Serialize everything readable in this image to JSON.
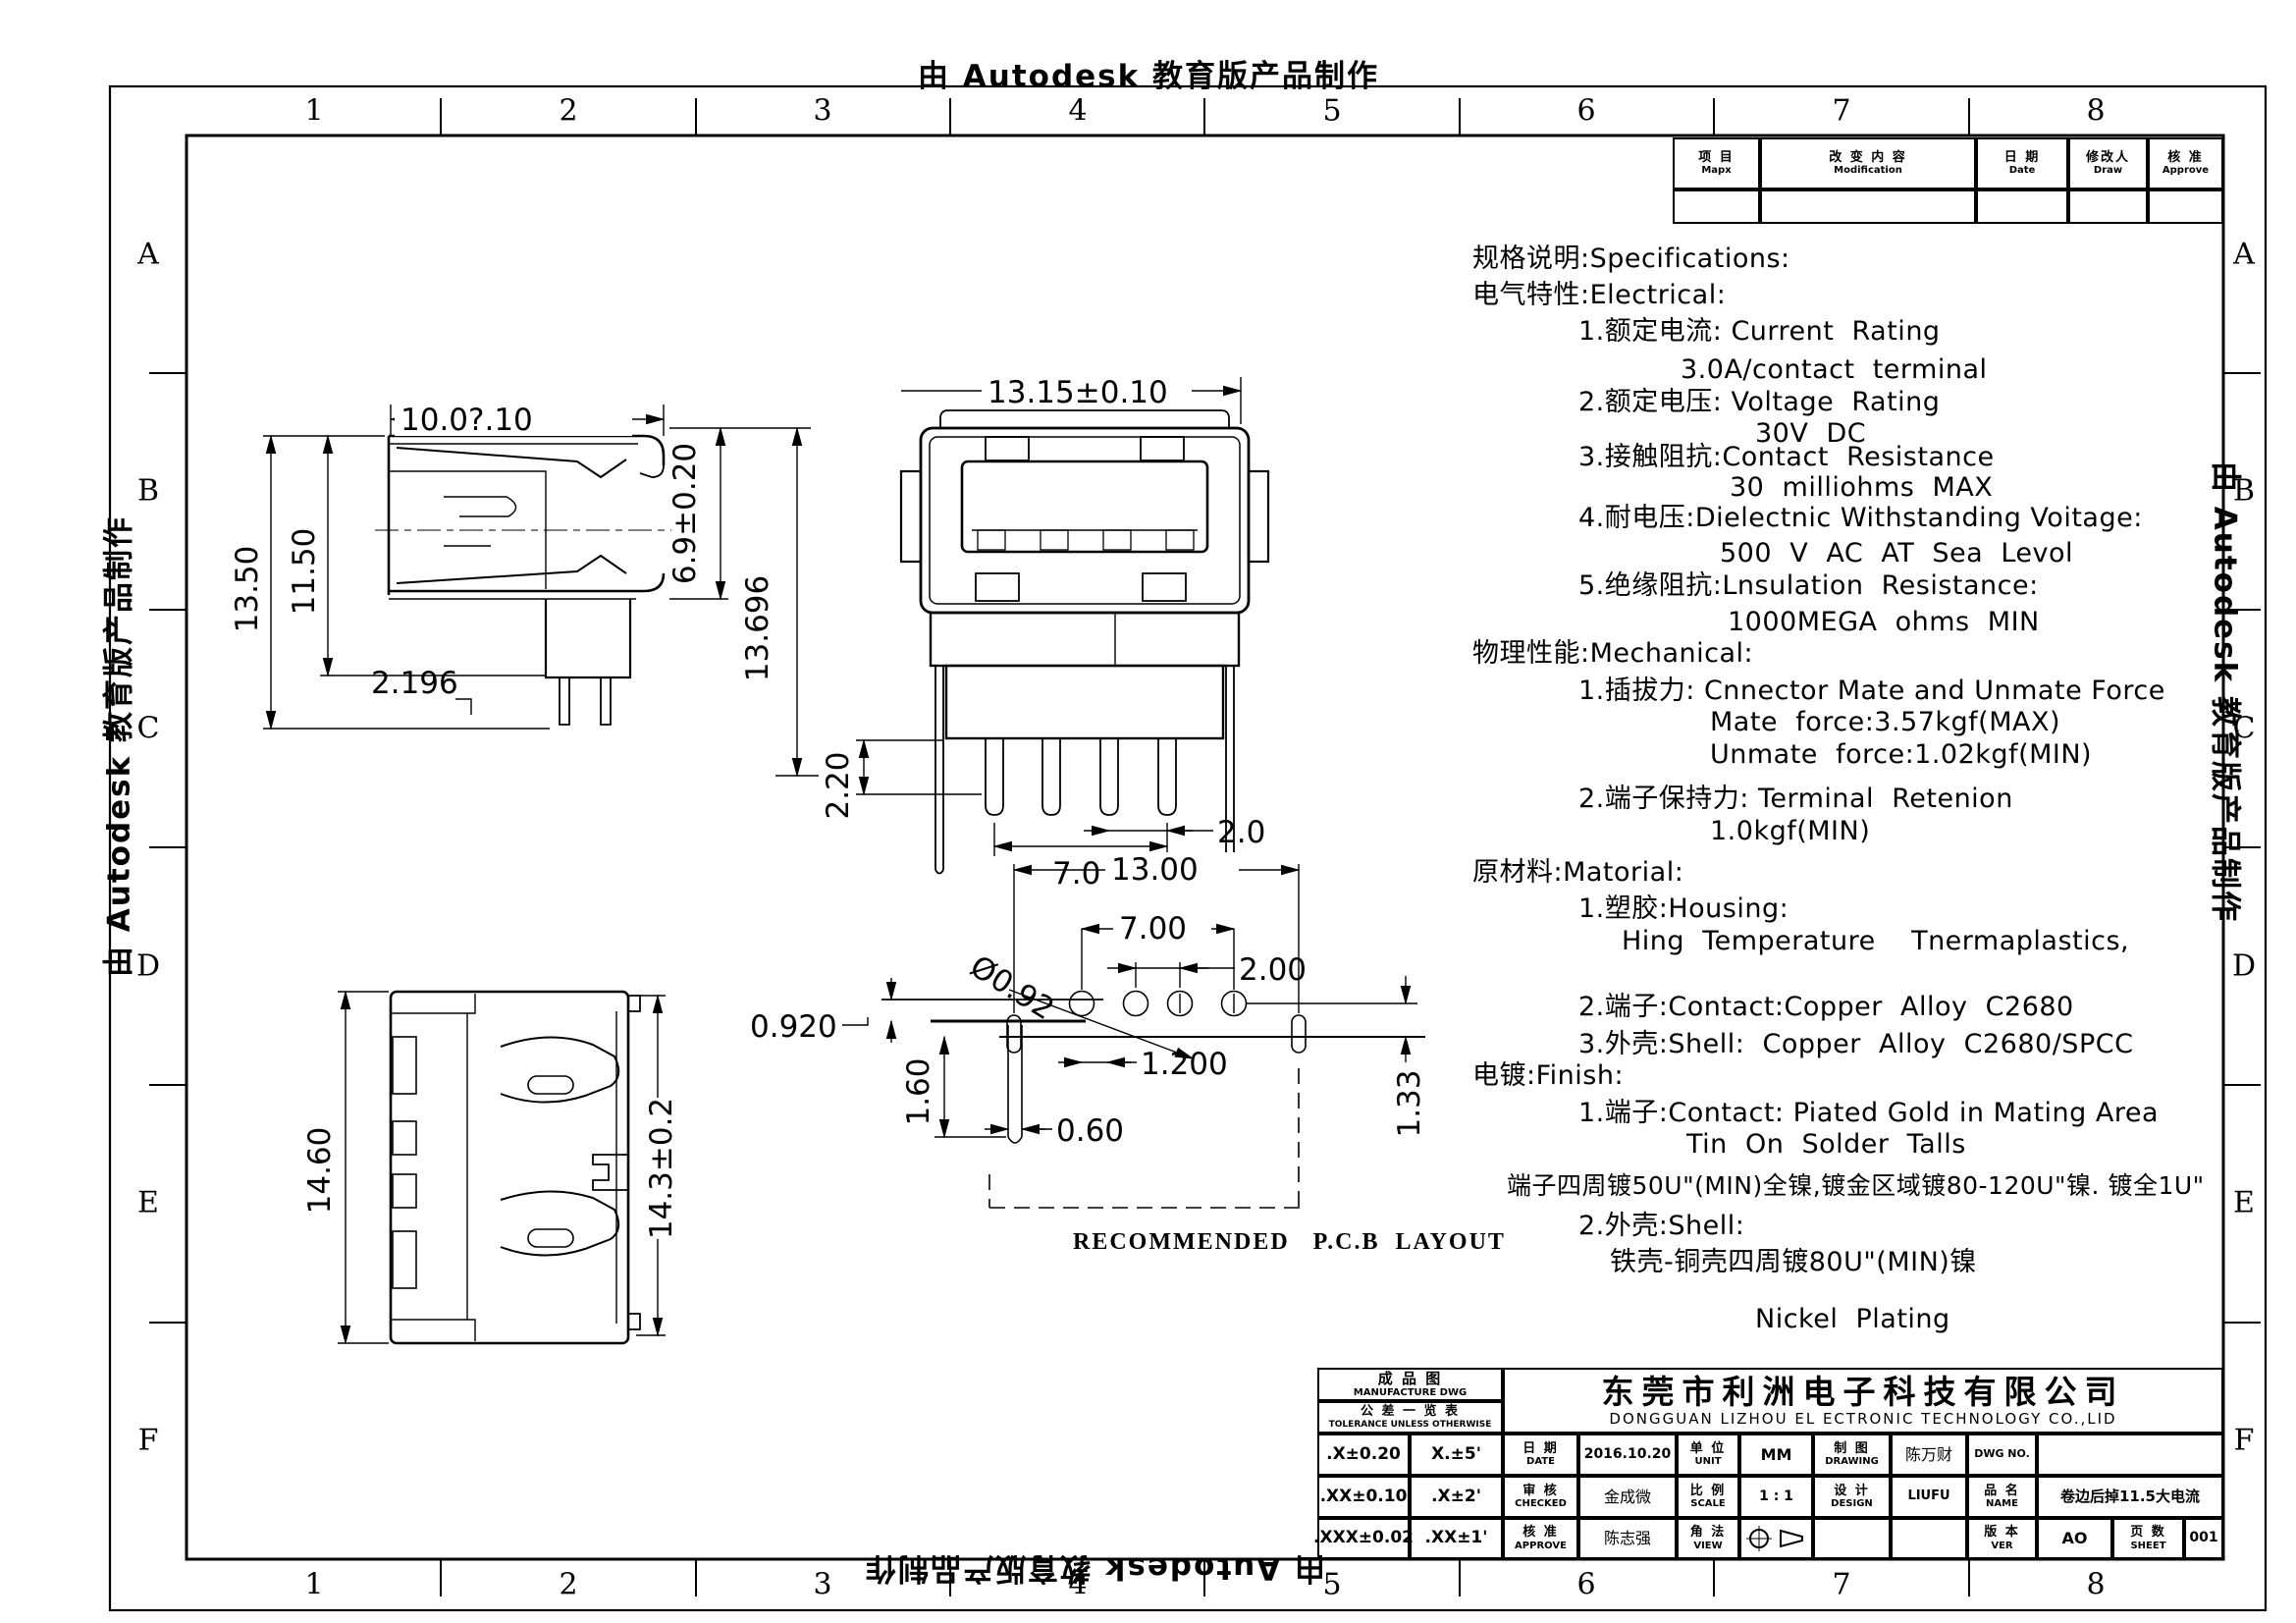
{
  "watermark": {
    "text": "由 Autodesk 教育版产品制作"
  },
  "grid": {
    "cols": [
      "1",
      "2",
      "3",
      "4",
      "5",
      "6",
      "7",
      "8"
    ],
    "rows": [
      "A",
      "B",
      "C",
      "D",
      "E",
      "F"
    ]
  },
  "revision_table": {
    "c1cn": "项  目",
    "c1en": "Mapx",
    "c2cn": "改 变 内 容",
    "c2en": "Modification",
    "c3cn": "日  期",
    "c3en": "Date",
    "c4cn": "修改人",
    "c4en": "Draw",
    "c5cn": "核  准",
    "c5en": "Approve"
  },
  "specs": {
    "lines": [
      "规格说明:Specifications:",
      "电气特性:Electrical:",
      "1.额定电流: Current  Rating",
      "3.0A/contact  terminal",
      "2.额定电压: Voltage  Rating",
      "30V  DC",
      "3.接触阻抗:Contact  Resistance",
      "30  milliohms  MAX",
      "4.耐电压:Dielectnic Withstanding Voitage:",
      "500  V  AC  AT  Sea  Levol",
      "5.绝缘阻抗:Lnsulation  Resistance:",
      "1000MEGA  ohms  MIN",
      "物理性能:Mechanical:",
      "1.插拔力: Cnnector Mate and Unmate Force",
      "Mate  force:3.57kgf(MAX)",
      "Unmate  force:1.02kgf(MIN)",
      "2.端子保持力: Terminal  Retenion",
      "1.0kgf(MIN)",
      "原材料:Matorial:",
      "1.塑胶:Housing:",
      "Hing  Temperature    Tnermaplastics,",
      "2.端子:Contact:Copper  Alloy  C2680",
      "3.外壳:Shell:  Copper  Alloy  C2680/SPCC",
      "电镀:Finish:",
      "1.端子:Contact: Piated Gold in Mating Area",
      "Tin  On  Solder  Talls",
      "端子四周镀50U\"(MIN)全镍,镀金区域镀80-120U\"镍. 镀全1U\"",
      "2.外壳:Shell:",
      "铁壳-铜壳四周镀80U\"(MIN)镍",
      "Nickel  Plating"
    ]
  },
  "dims": {
    "side_width": "10.0?.10",
    "side_h1": "13.50",
    "side_h2": "11.50",
    "side_note": "2.196",
    "front_width": "13.15±0.10",
    "front_height": "6.9±0.20",
    "front_total": "13.696",
    "front_pin_offset": "2.20",
    "front_pin_span": "7.0",
    "front_pin_pitch": "2.0",
    "rear_height": "14.60",
    "rear_height2": "14.3±0.2",
    "pcb_width": "13.00",
    "pcb_span": "7.00",
    "pcb_pitch": "2.00",
    "pcb_hole": "Ø0.92",
    "pcb_offset": "0.920",
    "pcb_p": "1.200",
    "pcb_slot_h": "1.60",
    "pcb_slot_w": "0.60",
    "pcb_d": "1.33"
  },
  "pcb_caption": "RECOMMENDED   P.C.B  LAYOUT",
  "title_block": {
    "mfg_cn": "成  品  图",
    "mfg_en": "MANUFACTURE DWG",
    "tol_cn": "公 差 一 览 表",
    "tol_en": "TOLERANCE UNLESS OTHERWISE",
    "tol_r1c1": ".X±0.20",
    "tol_r1c2": "X.±5'",
    "tol_r2c1": ".XX±0.10",
    "tol_r2c2": ".X±2'",
    "tol_r3c1": ".XXX±0.02",
    "tol_r3c2": ".XX±1'",
    "company_cn": "东莞市利洲电子科技有限公司",
    "company_en": "DONGGUAN LIZHOU EL ECTRONIC TECHNOLOGY CO.,LID",
    "date_cn": "日  期",
    "date_en": "DATE",
    "date_val": "2016.10.20",
    "unit_cn": "单  位",
    "unit_en": "UNIT",
    "unit_val": "MM",
    "drawing_cn": "制  图",
    "drawing_en": "DRAWING",
    "drawing_val": "陈万财",
    "dwgno_label": "DWG  NO.",
    "checked_cn": "审  核",
    "checked_en": "CHECKED",
    "checked_val": "金成微",
    "scale_cn": "比  例",
    "scale_en": "SCALE",
    "scale_val": "1 : 1",
    "design_cn": "设  计",
    "design_en": "DESIGN",
    "design_val": "LIUFU",
    "name_cn": "品  名",
    "name_en": "NAME",
    "name_val": "卷边后掉11.5大电流",
    "approve_cn": "核  准",
    "approve_en": "APPROVE",
    "approve_val": "陈志强",
    "view_cn": "角  法",
    "view_en": "VIEW",
    "ver_cn": "版  本",
    "ver_en": "VER",
    "ver_val": "AO",
    "sheet_cn": "页  数",
    "sheet_en": "SHEET",
    "sheet_val": "001"
  }
}
